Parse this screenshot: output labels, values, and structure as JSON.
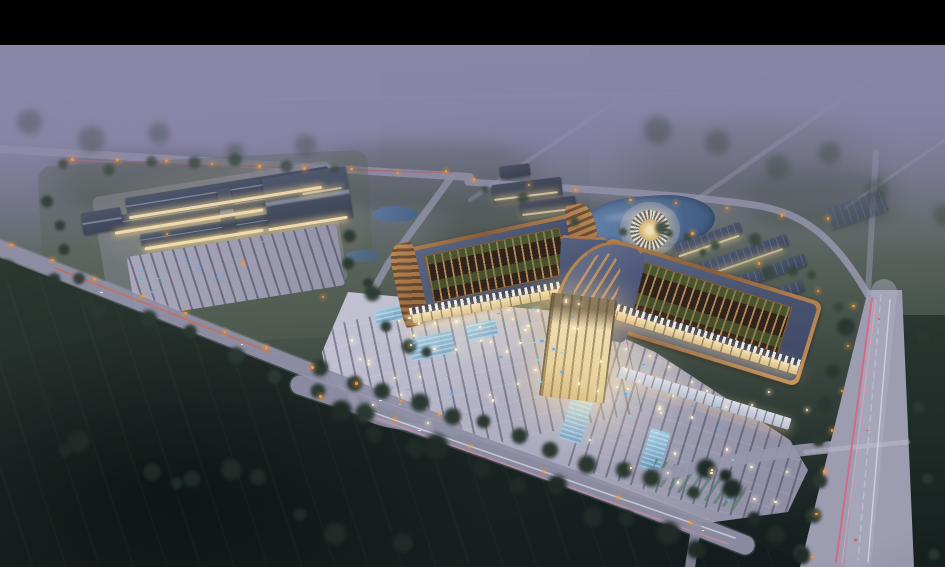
{
  "meta": {
    "description": "Dusk aerial architectural rendering of a large market / trade-center campus with two Chinese-style curved-roof exhibition halls, a secondary market complex, warehouses, a round pavilion by a pond, lit parking plazas and roads with car light trails",
    "type": "architectural-rendering",
    "time_of_day": "dusk",
    "letterbox": "black bar across the top of the frame"
  },
  "palette": {
    "letterbox": "#000000",
    "mist-top": "#8c88a9",
    "mist-mid": "#7b7a9c",
    "terrain-mid": "#59655b",
    "terrain-dark": "#232e2a",
    "field-darkest": "#141c1e",
    "road-light": "#9c9cb4",
    "road-pale": "#b7b7ca",
    "plaza-light": "#b8b7c9",
    "plaza-shadow": "#9594ab",
    "parking-row": "#3c4058",
    "roof-slate": "#46506b",
    "roof-slate-dark": "#38415a",
    "copper-trim": "#a0714a",
    "copper-light": "#c08a58",
    "skylight-beam": "#7a5c3e",
    "skylight-dark": "#2e241c",
    "courtyard-green": "#5c7440",
    "canopy-white": "#e9ecf3",
    "facade-warm": "#f0ddae",
    "window-glow": "#ffe3a0",
    "glass-blue": "#85bcdc",
    "water": "#4f6f96",
    "tree-green": "#3c4a3c",
    "tree-dark": "#26312b",
    "streetlight-orange": "#eb9a42",
    "trail-red": "#d4566a",
    "trail-pink": "#f090a6",
    "trail-white": "#e6e9f2",
    "car-blue": "#74a8d8"
  },
  "scene": {
    "landmarks": [
      {
        "name": "main-hall-west",
        "kind": "exhibition hall with upturned copper-trimmed slate roof and open skylight over green courtyards"
      },
      {
        "name": "main-hall-east",
        "kind": "exhibition hall, rotated, with large curved roof wing"
      },
      {
        "name": "central-entrance",
        "kind": "warm-lit entrance block joining the two halls"
      },
      {
        "name": "front-plaza-parking",
        "kind": "floodlit paved plaza with parking rows and glass skylight strips"
      },
      {
        "name": "secondary-market-complex",
        "kind": "cluster of lit low-rise market buildings with parking lot"
      },
      {
        "name": "round-pavilion",
        "kind": "circular rib-roofed pavilion beside pond"
      },
      {
        "name": "pond",
        "kind": "ornamental water body behind the halls"
      },
      {
        "name": "warehouse-rows",
        "kind": "three long storage buildings among trees"
      },
      {
        "name": "highway-east",
        "kind": "wide road with red and white car light trails"
      },
      {
        "name": "road-southwest",
        "kind": "diagonal road with orange street lights"
      },
      {
        "name": "front-road",
        "kind": "tree-lined road along the plaza"
      },
      {
        "name": "foreground-fields",
        "kind": "dark green fields with scattered trees"
      },
      {
        "name": "morning-mist",
        "kind": "purple haze over distant forest and roads"
      }
    ],
    "decorations": {
      "plaza_lights": 70,
      "street_lights": 47,
      "parked_cars": 30,
      "cyan_stall_lights": 16,
      "moving_cars": 8,
      "trees": 105
    }
  }
}
